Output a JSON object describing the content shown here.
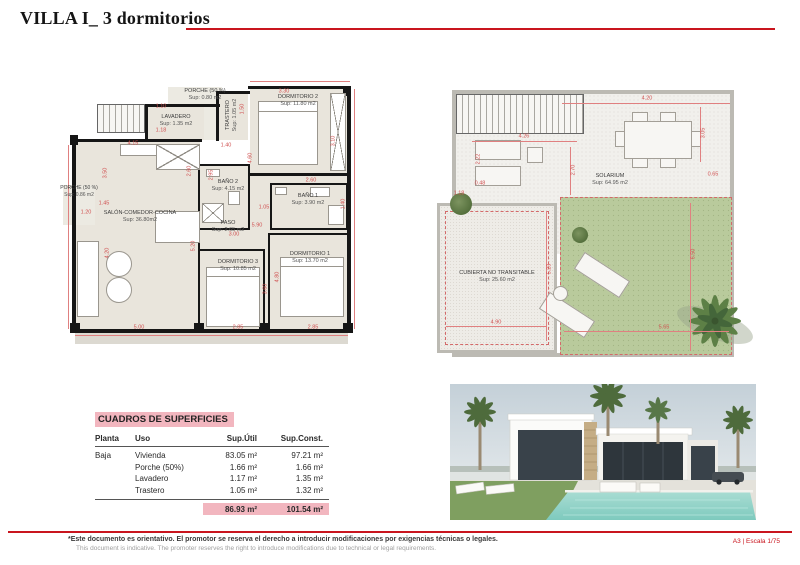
{
  "colors": {
    "accent_red": "#c9151e",
    "pink": "#f2b6bf",
    "floor_beige": "#e9e5dc",
    "garden_green": "#b9ca9c",
    "pool_turquoise": "#8ed1c6"
  },
  "header": {
    "title": "VILLA I_ 3 dormitorios"
  },
  "left_plan": {
    "rooms": [
      {
        "name": "PORCHE (50 %)",
        "area": "Sup: 0.80 m2"
      },
      {
        "name": "LAVADERO",
        "area": "Sup: 1.35 m2"
      },
      {
        "name": "TRASTERO",
        "area": "Sup: 1.05 m2"
      },
      {
        "name": "DORMITORIO 2",
        "area": "Sup: 11.80 m2"
      },
      {
        "name": "SALÓN-COMEDOR-COCINA",
        "area": "Sup: 36.80m2"
      },
      {
        "name": "BAÑO 2",
        "area": "Sup: 4.15 m2"
      },
      {
        "name": "BAÑO 1",
        "area": "Sup: 3.90 m2"
      },
      {
        "name": "PORCHE (50 %)",
        "area": "Sup: 0.86 m2"
      },
      {
        "name": "PASO",
        "area": "Sup: 2.65 m2"
      },
      {
        "name": "DORMITORIO 3",
        "area": "Sup: 10.85 m2"
      },
      {
        "name": "DORMITORIO 1",
        "area": "Sup: 13.70 m2"
      }
    ],
    "dims": [
      "4.15",
      "1.10",
      "1.18",
      "1.50",
      "3.30",
      "3.10",
      "3.50",
      "1.45",
      "1.20",
      "2.60",
      "2.95",
      "1.40",
      "4.60",
      "1.05",
      "2.60",
      "1.40",
      "5.20",
      "4.20",
      "3.00",
      "5.90",
      "4.80",
      "3.60",
      "5.00",
      "2.85",
      "2.85"
    ]
  },
  "right_plan": {
    "rooms": [
      {
        "name": "SOLARIUM",
        "area": "Sup: 64.95 m2"
      },
      {
        "name": "CUBIERTA NO TRANSITABLE",
        "area": "Sup: 25.60 m2"
      }
    ],
    "dims": [
      "4.20",
      "3.05",
      "0.65",
      "4.26",
      "2.22",
      "2.70",
      "0.48",
      "1.18",
      "5.23",
      "4.90",
      "6.50",
      "5.65"
    ]
  },
  "surfaces_table": {
    "title": "CUADROS DE SUPERFICIES",
    "headers": {
      "planta": "Planta",
      "uso": "Uso",
      "util": "Sup.Útil",
      "const": "Sup.Const."
    },
    "rows": [
      {
        "planta": "Baja",
        "uso": "Vivienda",
        "util": "83.05 m²",
        "const": "97.21 m²"
      },
      {
        "planta": "",
        "uso": "Porche (50%)",
        "util": "1.66 m²",
        "const": "1.66 m²"
      },
      {
        "planta": "",
        "uso": "Lavadero",
        "util": "1.17 m²",
        "const": "1.35 m²"
      },
      {
        "planta": "",
        "uso": "Trastero",
        "util": "1.05 m²",
        "const": "1.32 m²"
      }
    ],
    "total": {
      "util": "86.93 m²",
      "const": "101.54 m²"
    }
  },
  "footer": {
    "disclaimer_es": "*Este documento es orientativo. El promotor se reserva el derecho a introducir modificaciones por exigencias técnicas o legales.",
    "disclaimer_en": "This document is indicative. The promoter reserves the right to introduce modifications due to technical or legal requirements.",
    "sheet_info": "A3 | Escala 1/75"
  }
}
